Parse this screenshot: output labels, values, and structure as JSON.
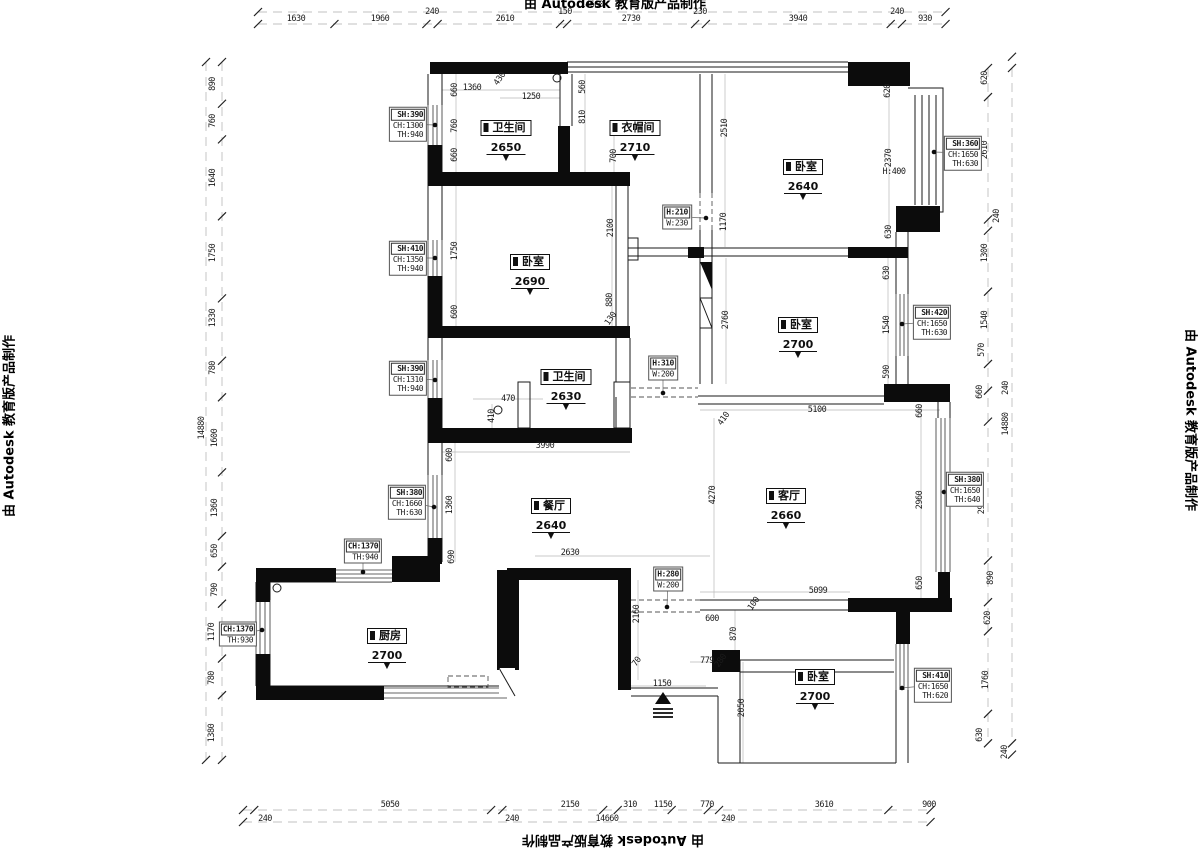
{
  "credit": {
    "text": "由 Autodesk 教育版产品制作"
  },
  "rooms": [
    {
      "name": "卫生间",
      "value": "2650",
      "x": 506,
      "y": 117
    },
    {
      "name": "衣帽间",
      "value": "2710",
      "x": 635,
      "y": 117
    },
    {
      "name": "卧室",
      "value": "2640",
      "x": 803,
      "y": 156
    },
    {
      "name": "卧室",
      "value": "2690",
      "x": 530,
      "y": 251
    },
    {
      "name": "卧室",
      "value": "2700",
      "x": 798,
      "y": 314
    },
    {
      "name": "卫生间",
      "value": "2630",
      "x": 566,
      "y": 366
    },
    {
      "name": "餐厅",
      "value": "2640",
      "x": 551,
      "y": 495
    },
    {
      "name": "客厅",
      "value": "2660",
      "x": 786,
      "y": 485
    },
    {
      "name": "厨房",
      "value": "2700",
      "x": 387,
      "y": 625
    },
    {
      "name": "卧室",
      "value": "2700",
      "x": 815,
      "y": 666
    }
  ],
  "specs": [
    {
      "lines": [
        "SH:390",
        "CH:1300",
        "TH:940"
      ],
      "x": 408,
      "y": 124,
      "dx": 435,
      "dy": 125
    },
    {
      "lines": [
        "SH:360",
        "CH:1650",
        "TH:630"
      ],
      "x": 963,
      "y": 153,
      "dx": 934,
      "dy": 152
    },
    {
      "lines": [
        "SH:410",
        "CH:1350",
        "TH:940"
      ],
      "x": 408,
      "y": 258,
      "dx": 435,
      "dy": 258
    },
    {
      "lines": [
        "SH:420",
        "CH:1650",
        "TH:630"
      ],
      "x": 932,
      "y": 322,
      "dx": 902,
      "dy": 324
    },
    {
      "lines": [
        "SH:390",
        "CH:1310",
        "TH:940"
      ],
      "x": 408,
      "y": 378,
      "dx": 435,
      "dy": 380
    },
    {
      "lines": [
        "H:210",
        "W:230"
      ],
      "x": 677,
      "y": 217,
      "dx": 706,
      "dy": 218
    },
    {
      "lines": [
        "H:310",
        "W:200"
      ],
      "x": 663,
      "y": 368,
      "dx": 663,
      "dy": 393
    },
    {
      "lines": [
        "SH:380",
        "CH:1660",
        "TH:630"
      ],
      "x": 407,
      "y": 502,
      "dx": 434,
      "dy": 507
    },
    {
      "lines": [
        "SH:380",
        "CH:1650",
        "TH:640"
      ],
      "x": 965,
      "y": 489,
      "dx": 944,
      "dy": 492
    },
    {
      "lines": [
        "CH:1370",
        "TH:940"
      ],
      "x": 363,
      "y": 551,
      "dx": 363,
      "dy": 572
    },
    {
      "lines": [
        "H:280",
        "W:200"
      ],
      "x": 668,
      "y": 579,
      "dx": 667,
      "dy": 607
    },
    {
      "lines": [
        "CH:1370",
        "TH:930"
      ],
      "x": 238,
      "y": 634,
      "dx": 262,
      "dy": 630
    },
    {
      "lines": [
        "SH:410",
        "CH:1650",
        "TH:620"
      ],
      "x": 933,
      "y": 685,
      "dx": 902,
      "dy": 688
    }
  ],
  "dims": [
    {
      "t": "660",
      "x": 455,
      "y": 90,
      "o": "v"
    },
    {
      "t": "1360",
      "x": 472,
      "y": 88,
      "o": "h"
    },
    {
      "t": "430",
      "x": 500,
      "y": 79,
      "o": "d"
    },
    {
      "t": "1250",
      "x": 531,
      "y": 97,
      "o": "h"
    },
    {
      "t": "560",
      "x": 583,
      "y": 87,
      "o": "v"
    },
    {
      "t": "810",
      "x": 583,
      "y": 117,
      "o": "v"
    },
    {
      "t": "700",
      "x": 614,
      "y": 156,
      "o": "v"
    },
    {
      "t": "760",
      "x": 455,
      "y": 126,
      "o": "v"
    },
    {
      "t": "660",
      "x": 455,
      "y": 155,
      "o": "v"
    },
    {
      "t": "2510",
      "x": 725,
      "y": 128,
      "o": "v"
    },
    {
      "t": "620",
      "x": 888,
      "y": 91,
      "o": "v"
    },
    {
      "t": "2370",
      "x": 889,
      "y": 158,
      "o": "v"
    },
    {
      "t": "H:400",
      "x": 894,
      "y": 172,
      "o": "h"
    },
    {
      "t": "630",
      "x": 889,
      "y": 232,
      "o": "v"
    },
    {
      "t": "1170",
      "x": 724,
      "y": 222,
      "o": "v"
    },
    {
      "t": "2100",
      "x": 611,
      "y": 228,
      "o": "v"
    },
    {
      "t": "1750",
      "x": 455,
      "y": 251,
      "o": "v"
    },
    {
      "t": "600",
      "x": 455,
      "y": 312,
      "o": "v"
    },
    {
      "t": "880",
      "x": 610,
      "y": 300,
      "o": "v"
    },
    {
      "t": "130",
      "x": 611,
      "y": 319,
      "o": "d"
    },
    {
      "t": "2760",
      "x": 726,
      "y": 320,
      "o": "v"
    },
    {
      "t": "630",
      "x": 887,
      "y": 273,
      "o": "v"
    },
    {
      "t": "1540",
      "x": 887,
      "y": 325,
      "o": "v"
    },
    {
      "t": "590",
      "x": 887,
      "y": 372,
      "o": "v"
    },
    {
      "t": "470",
      "x": 508,
      "y": 399,
      "o": "h"
    },
    {
      "t": "410",
      "x": 492,
      "y": 416,
      "o": "v"
    },
    {
      "t": "3990",
      "x": 545,
      "y": 446,
      "o": "h"
    },
    {
      "t": "600",
      "x": 450,
      "y": 455,
      "o": "v"
    },
    {
      "t": "1360",
      "x": 450,
      "y": 505,
      "o": "v"
    },
    {
      "t": "690",
      "x": 452,
      "y": 557,
      "o": "v"
    },
    {
      "t": "2630",
      "x": 570,
      "y": 553,
      "o": "h"
    },
    {
      "t": "2160",
      "x": 637,
      "y": 614,
      "o": "v"
    },
    {
      "t": "5100",
      "x": 817,
      "y": 410,
      "o": "h"
    },
    {
      "t": "410",
      "x": 724,
      "y": 419,
      "o": "d"
    },
    {
      "t": "4270",
      "x": 713,
      "y": 495,
      "o": "v"
    },
    {
      "t": "2960",
      "x": 920,
      "y": 500,
      "o": "v"
    },
    {
      "t": "660",
      "x": 920,
      "y": 411,
      "o": "v"
    },
    {
      "t": "650",
      "x": 920,
      "y": 583,
      "o": "v"
    },
    {
      "t": "5099",
      "x": 818,
      "y": 591,
      "o": "h"
    },
    {
      "t": "100",
      "x": 754,
      "y": 604,
      "o": "d"
    },
    {
      "t": "600",
      "x": 712,
      "y": 619,
      "o": "h"
    },
    {
      "t": "70",
      "x": 637,
      "y": 662,
      "o": "d"
    },
    {
      "t": "779",
      "x": 707,
      "y": 661,
      "o": "h"
    },
    {
      "t": "280",
      "x": 721,
      "y": 661,
      "o": "d"
    },
    {
      "t": "1150",
      "x": 662,
      "y": 684,
      "o": "h"
    },
    {
      "t": "870",
      "x": 734,
      "y": 634,
      "o": "v"
    },
    {
      "t": "2050",
      "x": 742,
      "y": 708,
      "o": "v"
    }
  ],
  "chains": {
    "top": {
      "values": [
        1630,
        1960,
        240,
        2610,
        150,
        2730,
        230,
        3940,
        240,
        930
      ],
      "labels": [
        {
          "t": "1630",
          "x": 296,
          "y": 19
        },
        {
          "t": "1960",
          "x": 380,
          "y": 19
        },
        {
          "t": "240",
          "x": 432,
          "y": 12
        },
        {
          "t": "2610",
          "x": 505,
          "y": 19
        },
        {
          "t": "150",
          "x": 565,
          "y": 12
        },
        {
          "t": "2730",
          "x": 631,
          "y": 19
        },
        {
          "t": "230",
          "x": 700,
          "y": 12
        },
        {
          "t": "3940",
          "x": 798,
          "y": 19
        },
        {
          "t": "240",
          "x": 897,
          "y": 12
        },
        {
          "t": "930",
          "x": 925,
          "y": 19
        },
        {
          "t": "14660",
          "x": 592,
          "y": 5
        }
      ]
    },
    "bottom": {
      "values": [
        240,
        5050,
        240,
        2150,
        310,
        1150,
        770,
        240,
        3610,
        900
      ],
      "labels": [
        {
          "t": "5050",
          "x": 390,
          "y": 805
        },
        {
          "t": "2150",
          "x": 570,
          "y": 805
        },
        {
          "t": "310",
          "x": 630,
          "y": 805
        },
        {
          "t": "1150",
          "x": 663,
          "y": 805
        },
        {
          "t": "770",
          "x": 707,
          "y": 805
        },
        {
          "t": "3610",
          "x": 824,
          "y": 805
        },
        {
          "t": "900",
          "x": 929,
          "y": 805
        },
        {
          "t": "240",
          "x": 265,
          "y": 819
        },
        {
          "t": "240",
          "x": 512,
          "y": 819
        },
        {
          "t": "240",
          "x": 728,
          "y": 819
        },
        {
          "t": "14660",
          "x": 607,
          "y": 819
        }
      ]
    },
    "left": {
      "values": [
        890,
        760,
        1640,
        1750,
        1330,
        780,
        1600,
        1360,
        650,
        790,
        1170,
        780,
        1380
      ],
      "labels": [
        {
          "t": "890",
          "x": 213,
          "y": 84
        },
        {
          "t": "760",
          "x": 213,
          "y": 121
        },
        {
          "t": "1640",
          "x": 213,
          "y": 178
        },
        {
          "t": "1750",
          "x": 213,
          "y": 253
        },
        {
          "t": "1330",
          "x": 213,
          "y": 318
        },
        {
          "t": "780",
          "x": 213,
          "y": 368
        },
        {
          "t": "1600",
          "x": 215,
          "y": 438
        },
        {
          "t": "1360",
          "x": 215,
          "y": 508
        },
        {
          "t": "650",
          "x": 215,
          "y": 551
        },
        {
          "t": "790",
          "x": 215,
          "y": 590
        },
        {
          "t": "1170",
          "x": 212,
          "y": 632
        },
        {
          "t": "780",
          "x": 212,
          "y": 678
        },
        {
          "t": "1380",
          "x": 212,
          "y": 733
        },
        {
          "t": "14880",
          "x": 202,
          "y": 428
        }
      ]
    },
    "right": {
      "values": [
        620,
        2610,
        240,
        1300,
        1540,
        570,
        660,
        2960,
        890,
        620,
        1760,
        630
      ],
      "outer": [
        240,
        240
      ],
      "labels": [
        {
          "t": "620",
          "x": 985,
          "y": 78
        },
        {
          "t": "2610",
          "x": 985,
          "y": 150
        },
        {
          "t": "240",
          "x": 997,
          "y": 216
        },
        {
          "t": "1300",
          "x": 985,
          "y": 253
        },
        {
          "t": "1540",
          "x": 985,
          "y": 320
        },
        {
          "t": "570",
          "x": 982,
          "y": 350
        },
        {
          "t": "660",
          "x": 980,
          "y": 392
        },
        {
          "t": "2960",
          "x": 982,
          "y": 505
        },
        {
          "t": "890",
          "x": 991,
          "y": 578
        },
        {
          "t": "620",
          "x": 988,
          "y": 618
        },
        {
          "t": "1760",
          "x": 986,
          "y": 680
        },
        {
          "t": "630",
          "x": 980,
          "y": 735
        },
        {
          "t": "240",
          "x": 1006,
          "y": 388
        },
        {
          "t": "14880",
          "x": 1006,
          "y": 424
        },
        {
          "t": "240",
          "x": 1005,
          "y": 752
        }
      ]
    }
  },
  "symbols": {
    "level_triangle": "▼"
  }
}
